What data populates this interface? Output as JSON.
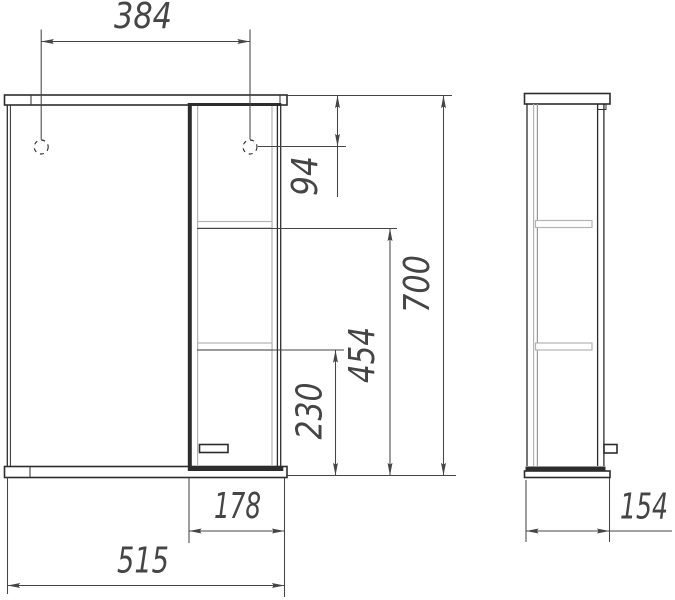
{
  "drawing": {
    "dims": {
      "hole_spacing": "384",
      "hole_offset_from_top": "94",
      "total_height": "700",
      "upper_shelf_from_bottom": "454",
      "lower_shelf_from_bottom": "230",
      "shelf_section_width": "178",
      "total_width": "515",
      "depth": "154"
    },
    "colors": {
      "line": "#2d2d2d",
      "medium": "#999999",
      "light": "#b3b3b3",
      "dimension": "#454545",
      "background": "#ffffff"
    }
  }
}
